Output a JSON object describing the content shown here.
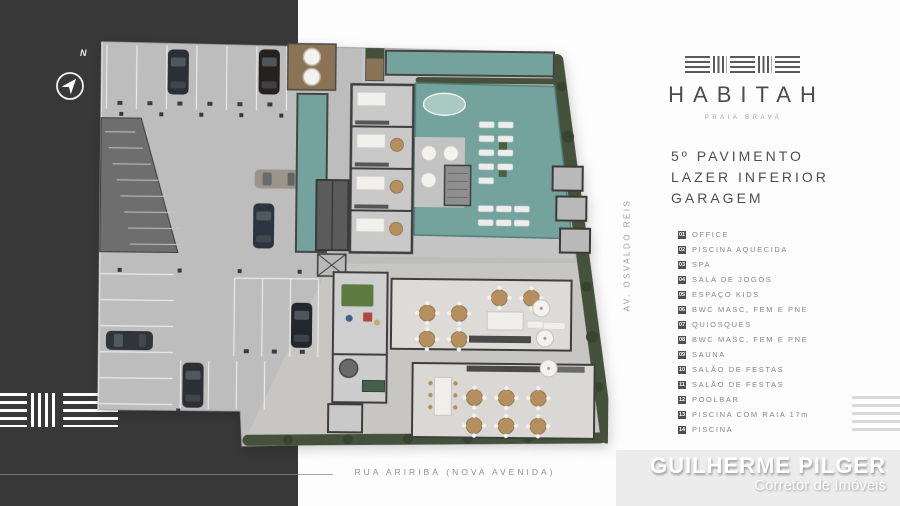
{
  "colors": {
    "panel_dark": "#383838",
    "slab": "#bdbdbd",
    "wall": "#3e3e3e",
    "pool": "#74a39e",
    "pool_light": "#abc9c3",
    "vegetation": "#46513c",
    "wood": "#8b7355",
    "tan": "#b5905e",
    "badge": "#4f4f4f",
    "footer_bg": "#ececec"
  },
  "compass": {
    "north_label": "N"
  },
  "brand": {
    "name": "HABITAH",
    "tagline": "PRAIA BRAVA"
  },
  "heading": {
    "line1": "5º PAVIMENTO",
    "line2": "LAZER INFERIOR",
    "line3": "GARAGEM"
  },
  "legend": {
    "items": [
      {
        "num": "01",
        "label": "OFFICE"
      },
      {
        "num": "02",
        "label": "PISCINA AQUECIDA"
      },
      {
        "num": "03",
        "label": "SPA"
      },
      {
        "num": "04",
        "label": "SALA DE JOGOS"
      },
      {
        "num": "05",
        "label": "ESPAÇO KIDS"
      },
      {
        "num": "06",
        "label": "BWC MASC, FEM E PNE"
      },
      {
        "num": "07",
        "label": "QUIOSQUES"
      },
      {
        "num": "08",
        "label": "BWC MASC, FEM E PNE"
      },
      {
        "num": "09",
        "label": "SAUNA"
      },
      {
        "num": "10",
        "label": "SALÃO DE FESTAS"
      },
      {
        "num": "11",
        "label": "SALÃO DE FESTAS"
      },
      {
        "num": "12",
        "label": "POOLBAR"
      },
      {
        "num": "13",
        "label": "PISCINA COM RAIA 17m"
      },
      {
        "num": "14",
        "label": "PISCINA"
      }
    ]
  },
  "streets": {
    "side": "AV. OSVALDO REIS",
    "bottom": "RUA ARIRIBÁ (NOVA AVENIDA)"
  },
  "footer": {
    "name": "GUILHERME PILGER",
    "role": "Corretor de Imóveis"
  }
}
